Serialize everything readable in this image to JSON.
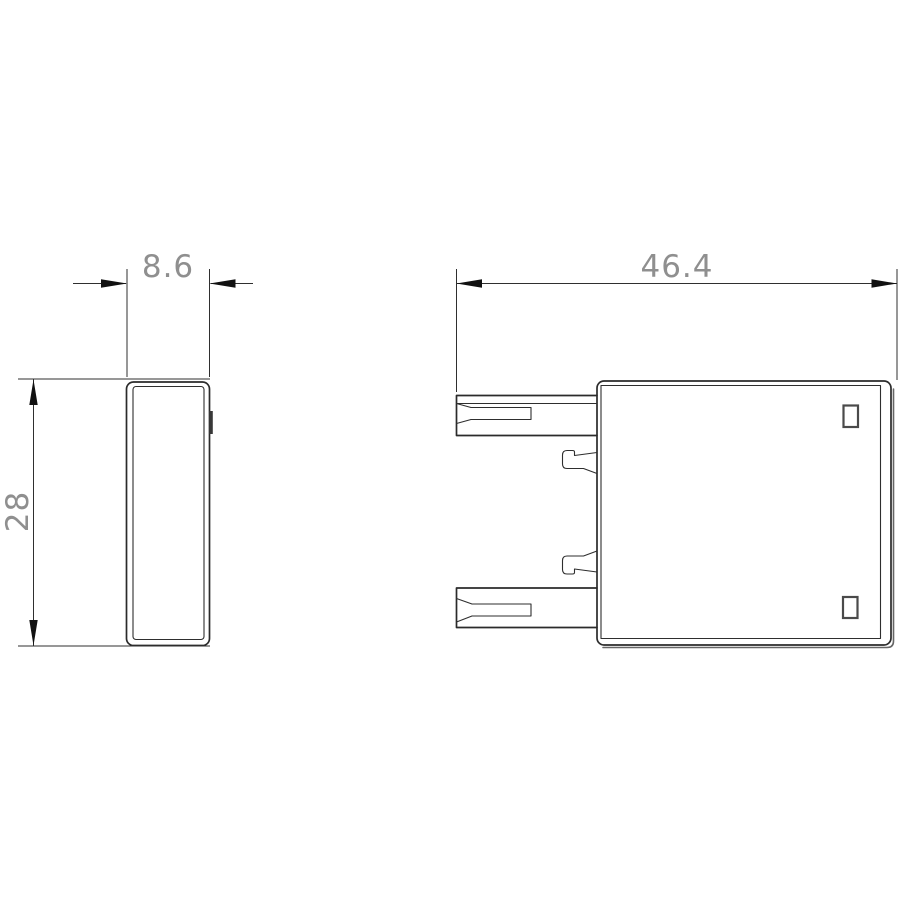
{
  "drawing": {
    "kind": "technical-dimension-drawing",
    "views": {
      "side_view": "narrow side elevation of accessory module",
      "front_view": "front elevation with two plug-in terminal blades and two snap hooks"
    }
  },
  "dimensions": {
    "side_width": "8.6",
    "front_depth": "46.4",
    "height": "28"
  },
  "colors": {
    "background": "#ffffff",
    "part_outline": "#2b2b2b",
    "inner_edge": "#2e2e2e",
    "shadow_edge": "#666666",
    "dimension_line": "#2f2f2f",
    "arrow_fill": "#111111",
    "dimension_text": "#8f8f8f"
  }
}
